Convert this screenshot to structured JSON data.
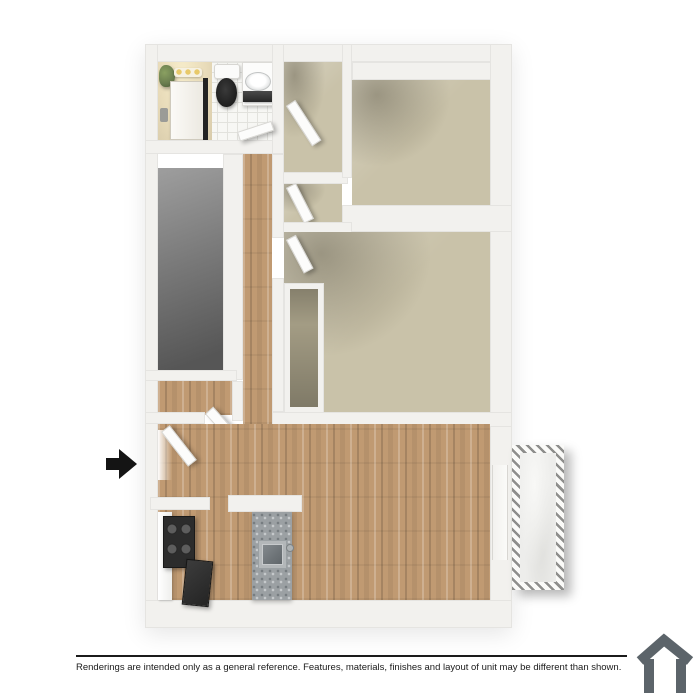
{
  "footer": {
    "disclaimer": "Renderings are intended only as a general reference. Features, materials, finishes and layout of unit may be different than shown."
  },
  "icons": {
    "entry_arrow": "entry-arrow-icon",
    "house_logo": "house-logo-icon"
  },
  "palette": {
    "wall": "#f2f1ee",
    "carpet": "#c9c2a9",
    "wood": "#c09a72",
    "gray_floor": "#777777",
    "tile": "#f7f7f4",
    "tile_line": "#e2e2dd",
    "granite": "#9ba0a3",
    "fixture_dark": "#1e1e1e",
    "patio_floor": "#ededeb",
    "shower_warm": "#e9dcba",
    "plant": "#6a7d4f",
    "accent_text": "#1b1b1b",
    "logo": "#5c646a"
  }
}
